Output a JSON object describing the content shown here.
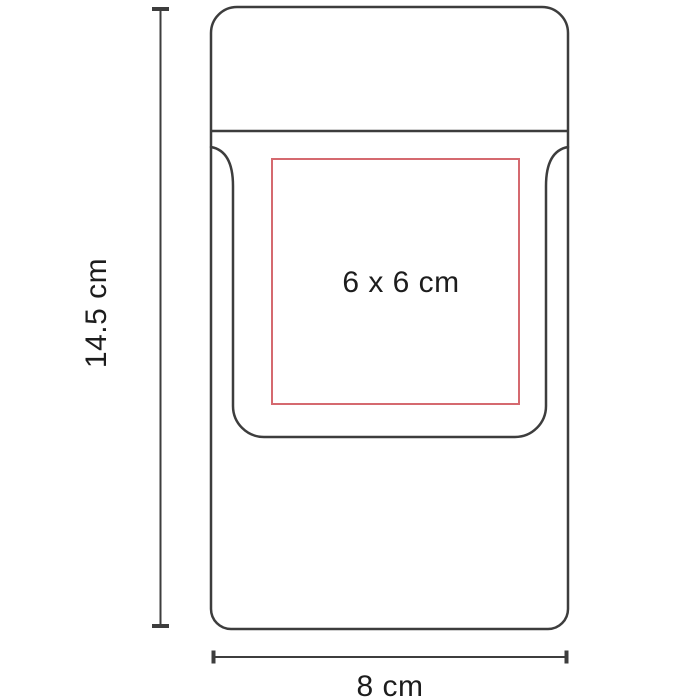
{
  "diagram": {
    "print_area": {
      "label": "6 x 6 cm"
    },
    "dimensions": {
      "height": {
        "label": "14.5 cm"
      },
      "width": {
        "label": "8 cm"
      }
    }
  },
  "colors": {
    "background": "#ffffff",
    "outline": "#3d3d3d",
    "print_area": "#d5696f",
    "text": "#1d1d1d"
  }
}
